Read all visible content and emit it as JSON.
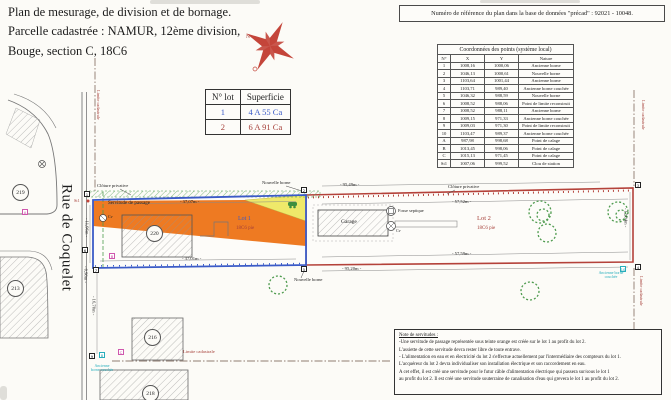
{
  "header": {
    "title_line1": "Plan de mesurage, de division et de bornage.",
    "title_line2": "Parcelle cadastrée : NAMUR, 12ème division,",
    "title_line3": "Bouge, section C, 18C6",
    "ref_box": "Numéro de référence du plan dans la base de données \"précad\" :   92021 - 10048."
  },
  "lot_table": {
    "col_lot": "N° lot",
    "col_area": "Superficie",
    "rows": [
      {
        "lot": "1",
        "area": "4 A 55 Ca"
      },
      {
        "lot": "2",
        "area": "6 A 91 Ca"
      }
    ]
  },
  "coord_table": {
    "title": "Coordonnées des points (système local)",
    "headers": [
      "N°",
      "X",
      "Y",
      "Nature"
    ],
    "rows": [
      {
        "n": "1",
        "x": "1008,16",
        "y": "1000,06",
        "nature": "Ancienne borne"
      },
      {
        "n": "2",
        "x": "1046,13",
        "y": "1000,61",
        "nature": "Nouvelle borne"
      },
      {
        "n": "3",
        "x": "1103,64",
        "y": "1001,44",
        "nature": "Ancienne borne"
      },
      {
        "n": "4",
        "x": "1103,71",
        "y": "989,40",
        "nature": "Ancienne borne couchée"
      },
      {
        "n": "5",
        "x": "1046,32",
        "y": "988,59",
        "nature": "Nouvelle borne"
      },
      {
        "n": "6",
        "x": "1008,52",
        "y": "988,06",
        "nature": "Point de limite reconstruit"
      },
      {
        "n": "7",
        "x": "1008,52",
        "y": "988,11",
        "nature": "Ancienne borne"
      },
      {
        "n": "8",
        "x": "1009,15",
        "y": "971,33",
        "nature": "Ancienne borne couchée"
      },
      {
        "n": "9",
        "x": "1009,03",
        "y": "971,30",
        "nature": "Point de limite reconstruit"
      },
      {
        "n": "10",
        "x": "1103,47",
        "y": "989,37",
        "nature": "Ancienne borne couchée"
      },
      {
        "n": "A",
        "x": "987,98",
        "y": "998,68",
        "nature": "Point de calage"
      },
      {
        "n": "B",
        "x": "1013,45",
        "y": "998,06",
        "nature": "Point de calage"
      },
      {
        "n": "C",
        "x": "1015,13",
        "y": "971,45",
        "nature": "Point de calage"
      },
      {
        "n": "St1",
        "x": "1007,06",
        "y": "999,52",
        "nature": "Clou de station"
      }
    ]
  },
  "plan": {
    "street": "Rue de Coquelet",
    "compass_north": "N",
    "labels": {
      "cloture": "Clôture privative",
      "servitude": "Servitude de passage",
      "nouvelle_borne": "Nouvelle borne",
      "ancienne_borne_couchee": "Ancienne borne couchée",
      "limite_cadastrale": "Limite cadastrale",
      "lot1": "Lot 1",
      "lot2": "Lot 2",
      "cadastre": "18C6 pie",
      "garage": "Garage",
      "fosse": "Fosse septique",
      "cv": "Cv"
    },
    "dimensions": {
      "lot1_top": "- 37,07m -",
      "lot1_bottom": "- 37,01m -",
      "lot1_left": "- 11,96m -",
      "seg_corner": "- 0,98m -",
      "seg_south": "- 16,70m -",
      "lot2_top": "- 95,49m -",
      "lot2_top_inner": "- 57,52m -",
      "lot2_bottom_inner": "- 57,59m -",
      "lot2_bottom": "- 95,20m -",
      "lot2_right": "- 12,04m -"
    },
    "points": {
      "p1": "1",
      "p2": "2",
      "p3": "3",
      "p4": "4",
      "p5": "5",
      "p6": "6",
      "p7": "7",
      "p8": "8",
      "p9": "9",
      "p10": "10",
      "pA": "A",
      "pB": "B",
      "pC": "C",
      "st1": "St1"
    },
    "parcels": {
      "p219": "219",
      "p213": "213",
      "p220": "220",
      "p216": "216",
      "p218": "218"
    }
  },
  "notes": {
    "title": "Note de servitudes :",
    "lines": [
      "-Une servitude de passage représentée sous teinte orange est créée sur le lot 1 au profit du lot 2.",
      "L'assiette de cette servitude devra rester libre de toute entrave.",
      "- L'alimentation en eau et en électricité du lot 2 s'effectue actuellement par l'intermédiaire des compteurs du lot 1.",
      "L'acquéreur du lot 2 devra individualiser son installation électrique et son raccordement en eau.",
      "A cet effet, il est créé une servitude pour le futur câble d'alimentation électrique qui passera sur/sous le lot 1",
      "au profit du lot 2. Il est créé une servitude souterraine de canalisation d'eau qui grevera le lot 1 au profit du lot 2."
    ]
  },
  "colors": {
    "lot1_border": "#3b5bc7",
    "lot2_border": "#b4423a",
    "servitude_orange": "#ee7a22",
    "wedge_yellow": "#efe96a",
    "hedge_green": "#4e9b4e",
    "calage_magenta": "#cf57ad",
    "couchee_cyan": "#27aebc",
    "compass_red": "#c4453a"
  }
}
